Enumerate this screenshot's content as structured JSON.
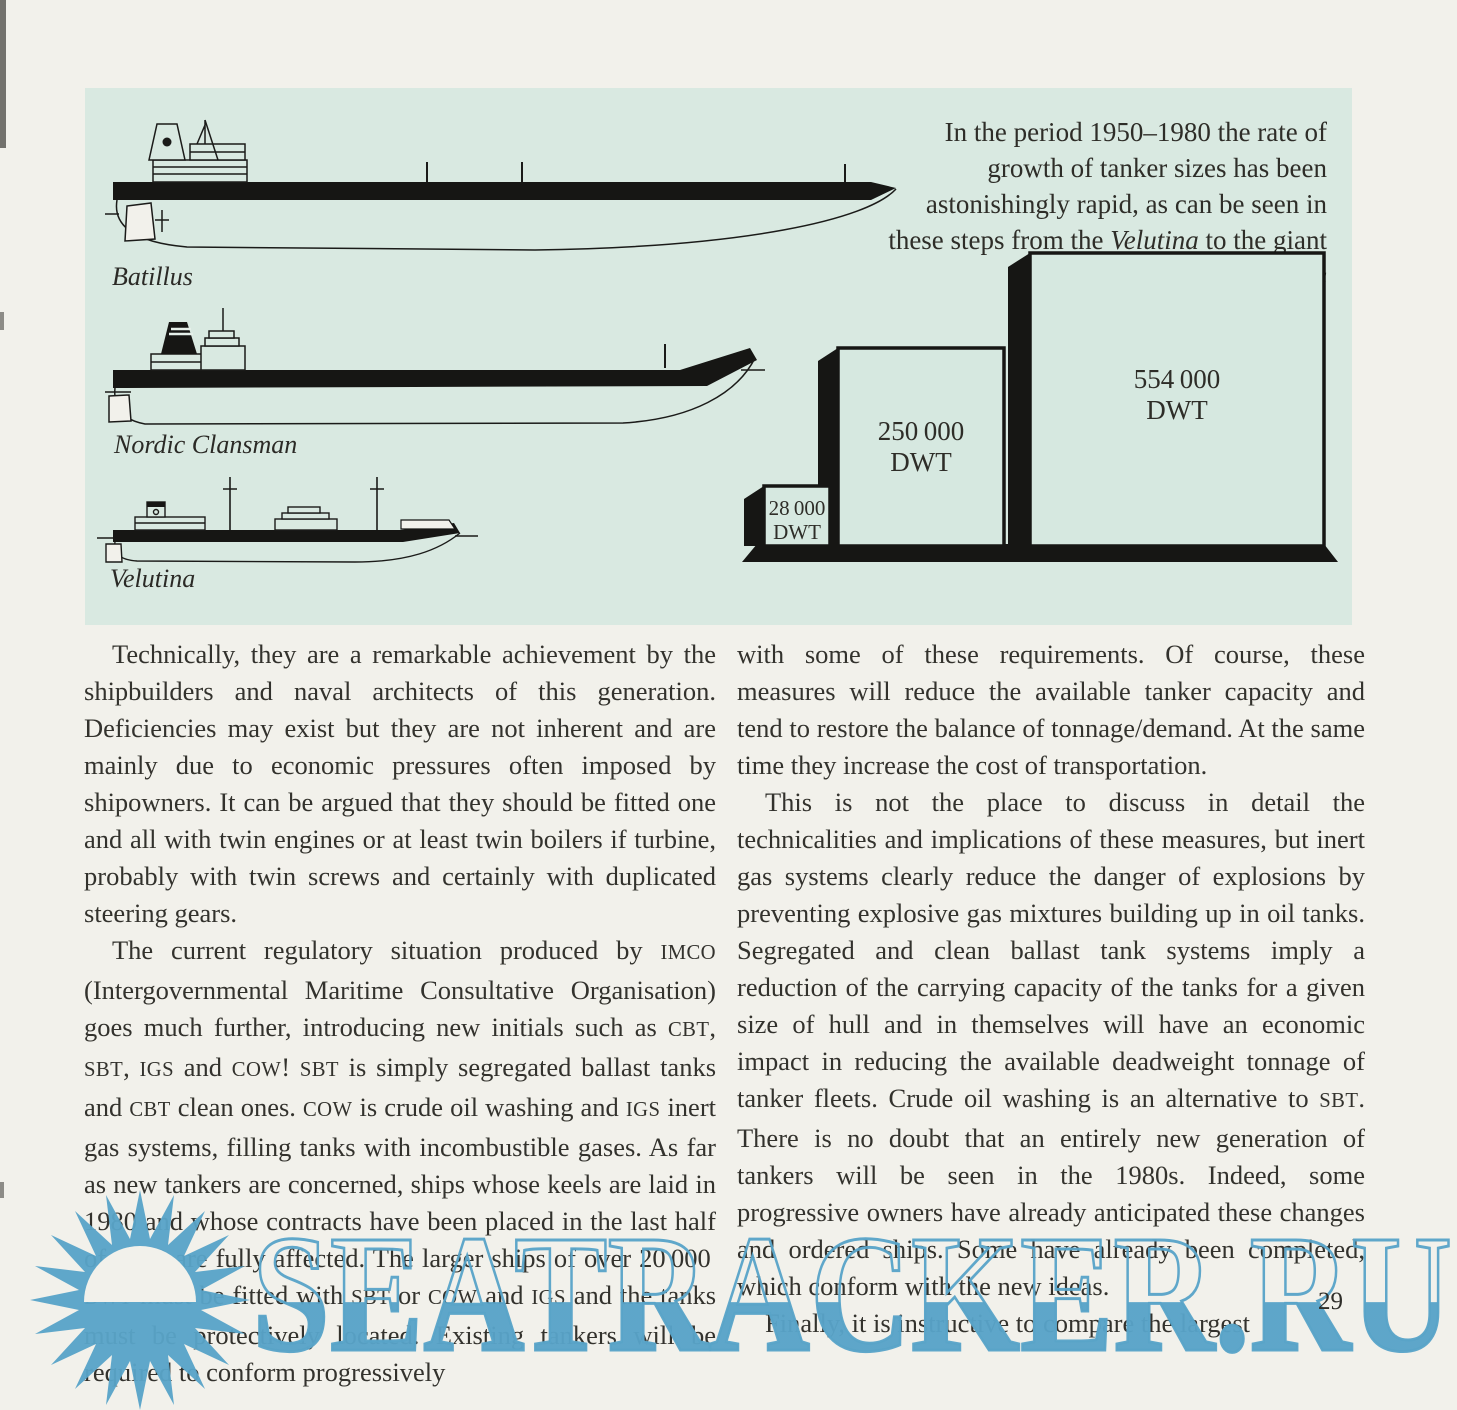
{
  "page": {
    "number": "29",
    "background": "#f2f1eb"
  },
  "figure": {
    "panel_color": "#d9e9e1",
    "caption_segments": [
      {
        "t": "In the period 1950–1980 the rate of growth of tanker sizes has been astonishingly rapid, as can be seen in these steps from the "
      },
      {
        "t": "Velutina",
        "i": true
      },
      {
        "t": " to the giant "
      },
      {
        "t": "Batillus",
        "i": true
      }
    ],
    "ships": [
      {
        "label": "Batillus"
      },
      {
        "label": "Nordic Clansman"
      },
      {
        "label": "Velutina"
      }
    ]
  },
  "chart_data": {
    "type": "bar",
    "title": "Growth of tanker sizes 1950–1980 (from the Velutina to the giant Batillus)",
    "categories": [
      "Velutina",
      "Nordic Clansman",
      "Batillus"
    ],
    "values": [
      28000,
      250000,
      554000
    ],
    "unit": "DWT",
    "legend_position": "none",
    "grid": false,
    "bars": [
      {
        "value_label": "28 000",
        "unit_label": "DWT",
        "dwt": 28000
      },
      {
        "value_label": "250 000",
        "unit_label": "DWT",
        "dwt": 250000
      },
      {
        "value_label": "554 000",
        "unit_label": "DWT",
        "dwt": 554000
      }
    ]
  },
  "article": {
    "left_column": {
      "paragraphs": [
        {
          "segments": [
            {
              "t": "Technically, they are a remarkable achievement by the shipbuilders and naval architects of this generation. Deficiencies may exist but they are not inherent and are mainly due to economic pressures often imposed by shipowners. It can be argued that they should be fitted one and all with twin engines or at least twin boilers if turbine, probably with twin screws and certainly with duplicated steering gears."
            }
          ]
        },
        {
          "segments": [
            {
              "t": "The current regulatory situation produced by "
            },
            {
              "t": "IMCO",
              "sc": true
            },
            {
              "t": " (Intergovernmental Maritime Consultative Organisation) goes much further, introducing new initials such as "
            },
            {
              "t": "CBT",
              "sc": true
            },
            {
              "t": ", "
            },
            {
              "t": "SBT",
              "sc": true
            },
            {
              "t": ", "
            },
            {
              "t": "IGS",
              "sc": true
            },
            {
              "t": " and "
            },
            {
              "t": "COW",
              "sc": true
            },
            {
              "t": "! "
            },
            {
              "t": "SBT",
              "sc": true
            },
            {
              "t": " is simply segregated ballast tanks and "
            },
            {
              "t": "CBT",
              "sc": true
            },
            {
              "t": " clean ones. "
            },
            {
              "t": "COW",
              "sc": true
            },
            {
              "t": " is crude oil washing and "
            },
            {
              "t": "IGS",
              "sc": true
            },
            {
              "t": " inert gas systems, filling tanks with incombustible gases. As far as new tankers are concerned, ships whose keels are laid in 1980 and whose contracts have been placed in the last half of 1979 are fully affected. The larger ships of over 20 000 "
            },
            {
              "t": "DWT",
              "sc": true
            },
            {
              "t": " must be fitted with "
            },
            {
              "t": "SBT",
              "sc": true
            },
            {
              "t": " or "
            },
            {
              "t": "COW",
              "sc": true
            },
            {
              "t": " and "
            },
            {
              "t": "IGS",
              "sc": true
            },
            {
              "t": " and the tanks must be protectively located. Existing tankers will be required to conform progressively"
            }
          ]
        }
      ]
    },
    "right_column": {
      "paragraphs": [
        {
          "segments": [
            {
              "t": "with some of these requirements. Of course, these measures will reduce the available tanker capacity and tend to restore the balance of tonnage/demand. At the same time they increase the cost of transportation."
            }
          ]
        },
        {
          "segments": [
            {
              "t": "This is not the place to discuss in detail the technicalities and implications of these measures, but inert gas systems clearly reduce the danger of explosions by preventing explosive gas mixtures building up in oil tanks. Segregated and clean ballast tank systems imply a reduction of the carrying capacity of the tanks for a given size of hull and in themselves will have an economic impact in reducing the available deadweight tonnage of tanker fleets. Crude oil washing is an alternative to "
            },
            {
              "t": "SBT",
              "sc": true
            },
            {
              "t": ". There is no doubt that an entirely new generation of tankers will be seen in the 1980s. Indeed, some progressive owners have already anticipated these changes and ordered ships. Some have already been completed, which conform with the new ideas."
            }
          ]
        },
        {
          "segments": [
            {
              "t": "Finally, it is instructive to compare the largest"
            }
          ]
        }
      ]
    }
  },
  "watermark": {
    "text": "SEATRACKER.RU",
    "color": "#58a3c8"
  }
}
